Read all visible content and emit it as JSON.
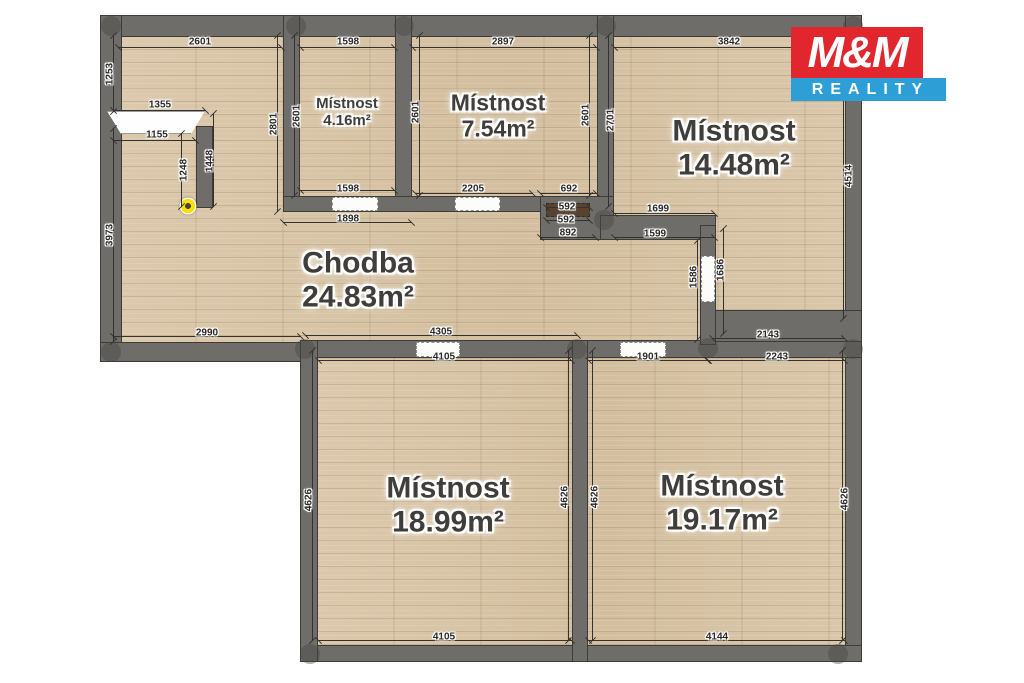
{
  "brand": {
    "logo_line1": "M&M",
    "logo_line2": "REALITY",
    "red": "#e1262d",
    "blue": "#2e9fd6"
  },
  "rooms": {
    "r416": {
      "name": "Místnost",
      "area": "4.16m²"
    },
    "r754": {
      "name": "Místnost",
      "area": "7.54m²"
    },
    "r1448": {
      "name": "Místnost",
      "area": "14.48m²"
    },
    "chodba": {
      "name": "Chodba",
      "area": "24.83m²"
    },
    "r1899": {
      "name": "Místnost",
      "area": "18.99m²"
    },
    "r1917": {
      "name": "Místnost",
      "area": "19.17m²"
    }
  },
  "dims": {
    "entry_top": "2601",
    "entry_left_upper": "1253",
    "entry_left_lower": "3973",
    "entry_right": "2801",
    "closet_top": "1355",
    "closet_bottom": "1155",
    "closet_left": "1248",
    "closet_right": "1448",
    "hall_bottom_left": "2990",
    "r416_top": "1598",
    "r416_left": "2601",
    "r416_bottom": "1598",
    "r416_bottom_outer": "1898",
    "r754_top": "2897",
    "r754_left": "2601",
    "r754_right": "2601",
    "r754_bottom": "2205",
    "r754_bottom_right": "692",
    "passage_upper": "592",
    "passage_lower": "592",
    "hall_top_mid": "892",
    "hall_top_right": "1599",
    "r1448_top": "3842",
    "r1448_left": "2701",
    "r1448_right": "4514",
    "r1448_bottom_left": "1699",
    "r1448_bottom_right": "2143",
    "r1448_door_left": "1586",
    "r1448_door_right": "1686",
    "r1899_top_outer": "4305",
    "r1899_top": "4105",
    "r1899_left": "4626",
    "r1899_right": "4626",
    "r1899_bottom": "4105",
    "r1917_top_left": "1901",
    "r1917_top_right": "2243",
    "r1917_left": "4626",
    "r1917_right": "4626",
    "r1917_bottom": "4144"
  }
}
